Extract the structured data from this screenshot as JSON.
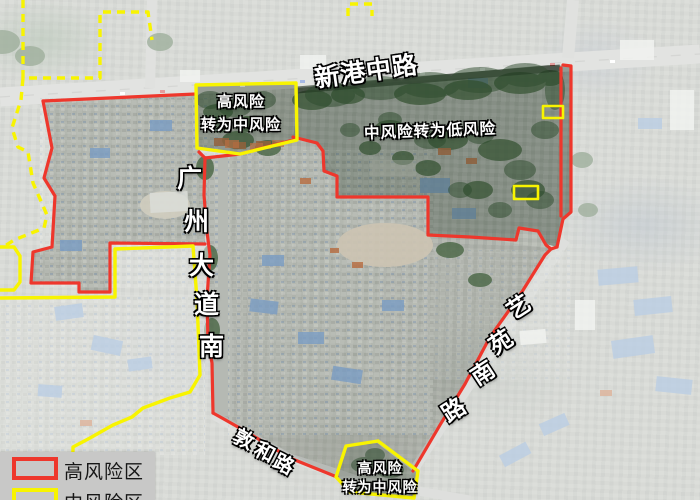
{
  "colors": {
    "high_risk_red": "#ee372c",
    "medium_risk_yellow": "#f8f400"
  },
  "roads": {
    "xingang_middle_road": "新港中路",
    "guangzhou_avenue_south_chars": [
      "广",
      "州",
      "大",
      "道",
      "南"
    ],
    "yiyuan_south_road_chars": [
      "艺",
      "苑",
      "南",
      "路"
    ],
    "dunhe_road_chars": [
      "敦",
      "和",
      "路"
    ]
  },
  "zone_labels": {
    "top_transition_line1": "高风险",
    "top_transition_line2": "转为中风险",
    "mid_to_low": "中风险转为低风险",
    "bottom_transition_line1": "高风险",
    "bottom_transition_line2": "转为中风险"
  },
  "legend": {
    "high_risk_label": "高风险区",
    "medium_risk_label": "中风险区"
  }
}
